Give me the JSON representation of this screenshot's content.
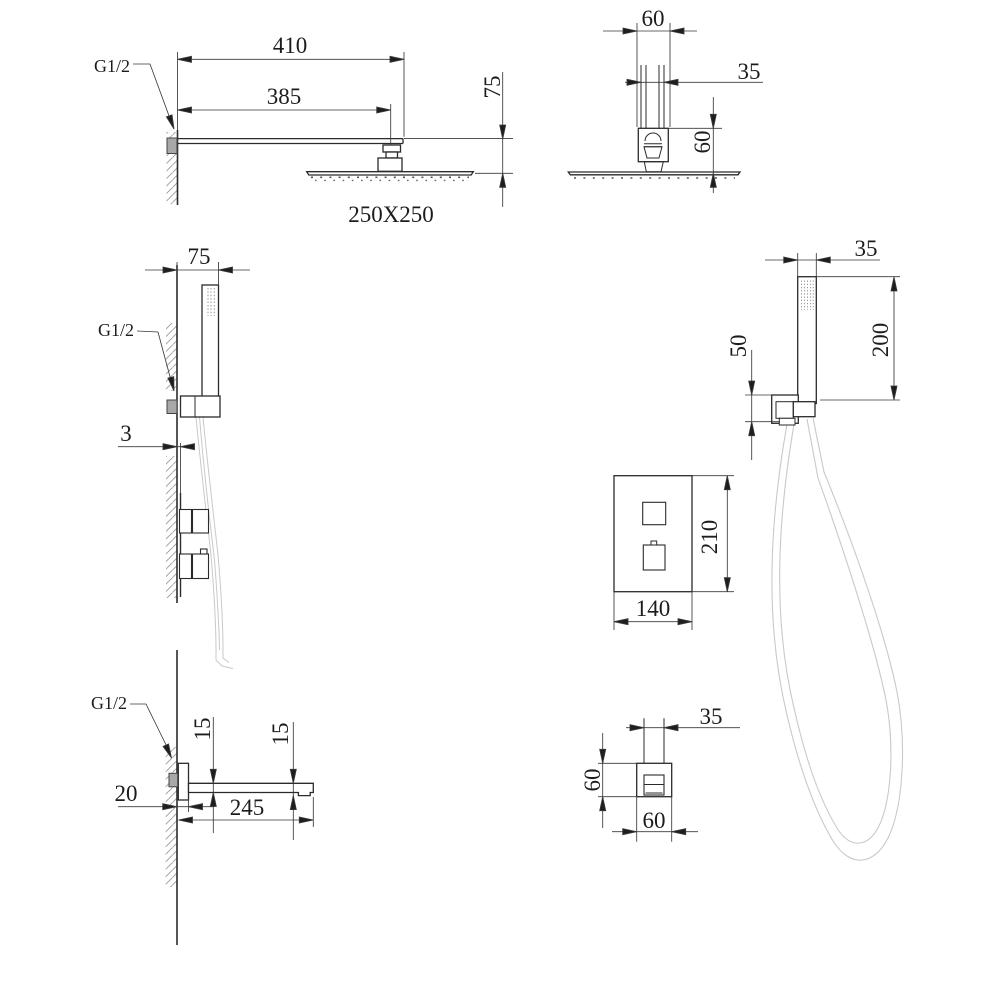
{
  "drawing": {
    "background": "#ffffff",
    "colors": {
      "line": "#2b2b2b",
      "dim": "#3a3a3a",
      "arrow": "#1e1e1e",
      "hose": "#c9c9c9",
      "metal": "#a8a8a8",
      "hatch": "#9a9a9a"
    },
    "views": {
      "rain_side": {
        "dim_total": "410",
        "dim_arm": "385",
        "dim_drop": "75",
        "dim_head": "250X250",
        "thread": "G1/2"
      },
      "rain_front": {
        "dim_top": "60",
        "dim_pipe": "35",
        "dim_height": "60"
      },
      "hand_side": {
        "dim_offset": "75",
        "thread": "G1/2",
        "dim_plate": "3"
      },
      "hand_front": {
        "dim_width": "35",
        "dim_height": "200",
        "dim_bracket": "50"
      },
      "valve": {
        "dim_height": "210",
        "dim_width": "140"
      },
      "spout_side": {
        "thread": "G1/2",
        "dim_thickness": "15",
        "dim_tip": "15",
        "dim_wall": "20",
        "dim_length": "245"
      },
      "spout_front": {
        "dim_pipe": "35",
        "dim_height": "60",
        "dim_width": "60"
      }
    }
  }
}
